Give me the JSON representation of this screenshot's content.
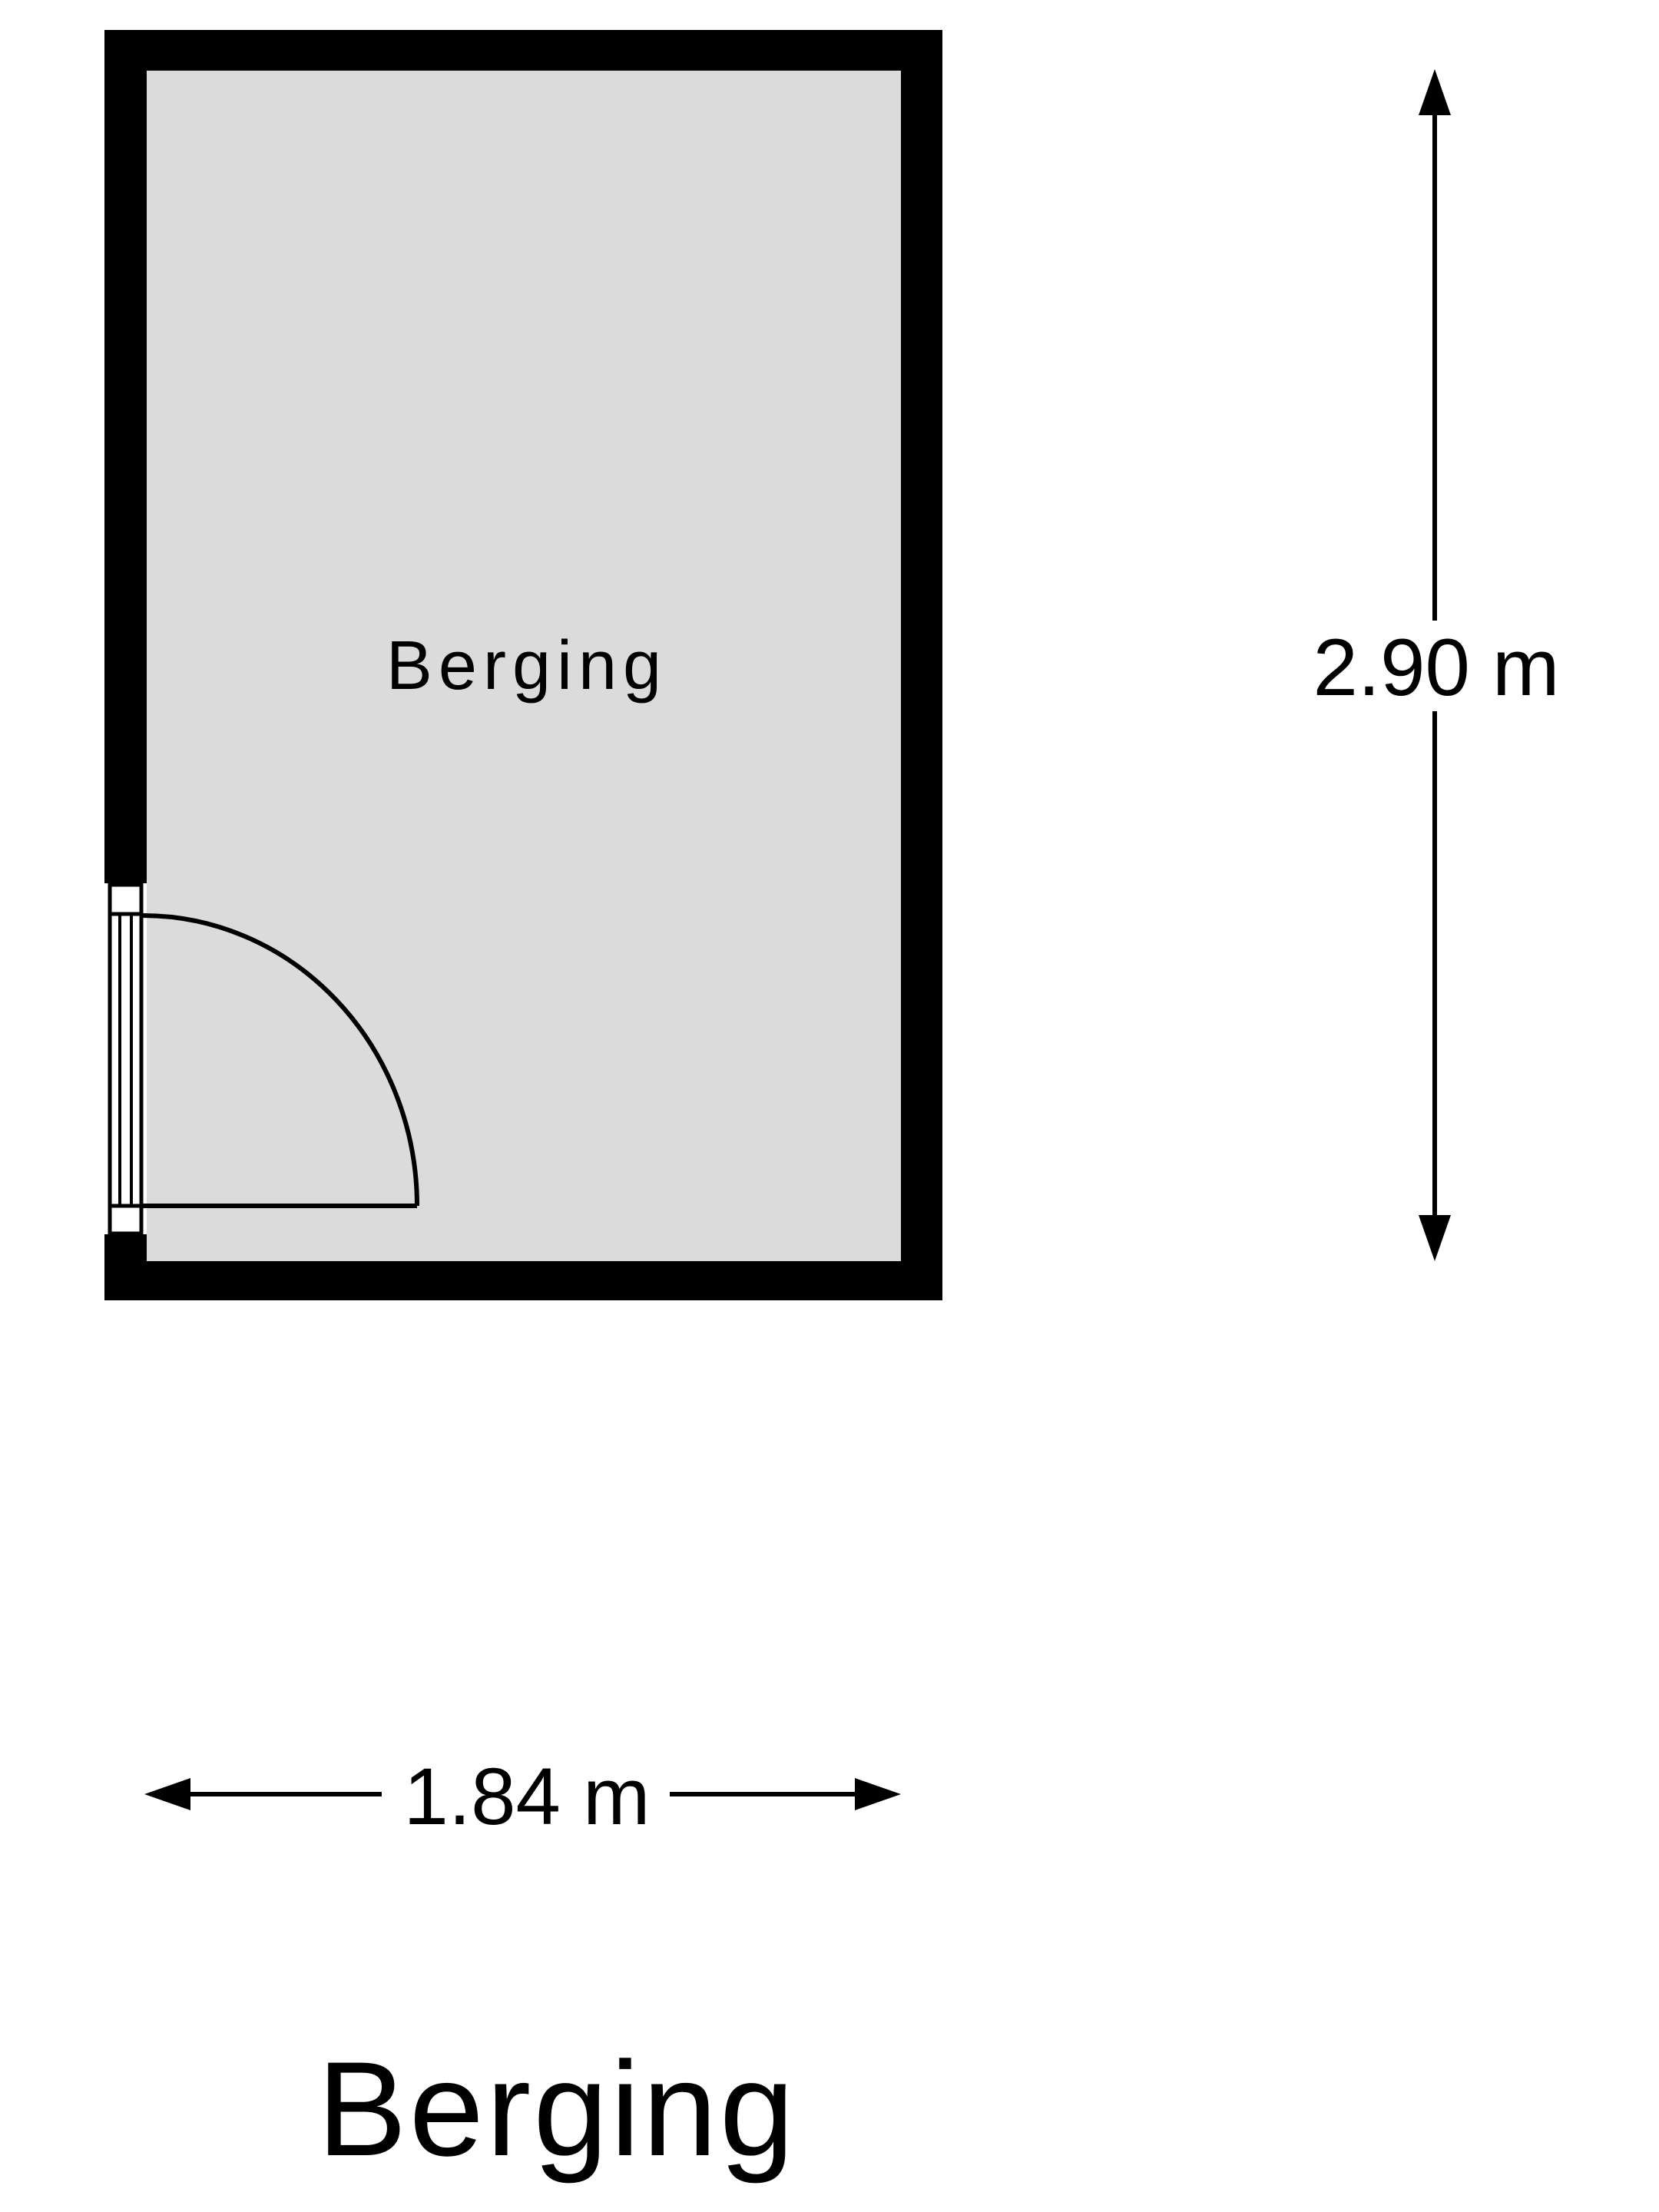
{
  "plan": {
    "room_label": "Berging",
    "title": "Berging",
    "dimensions": {
      "height": "2.90 m",
      "width": "1.84 m"
    },
    "colors": {
      "wall": "#000000",
      "floor": "#dbdbdb",
      "background": "#ffffff",
      "stroke": "#000000"
    }
  }
}
